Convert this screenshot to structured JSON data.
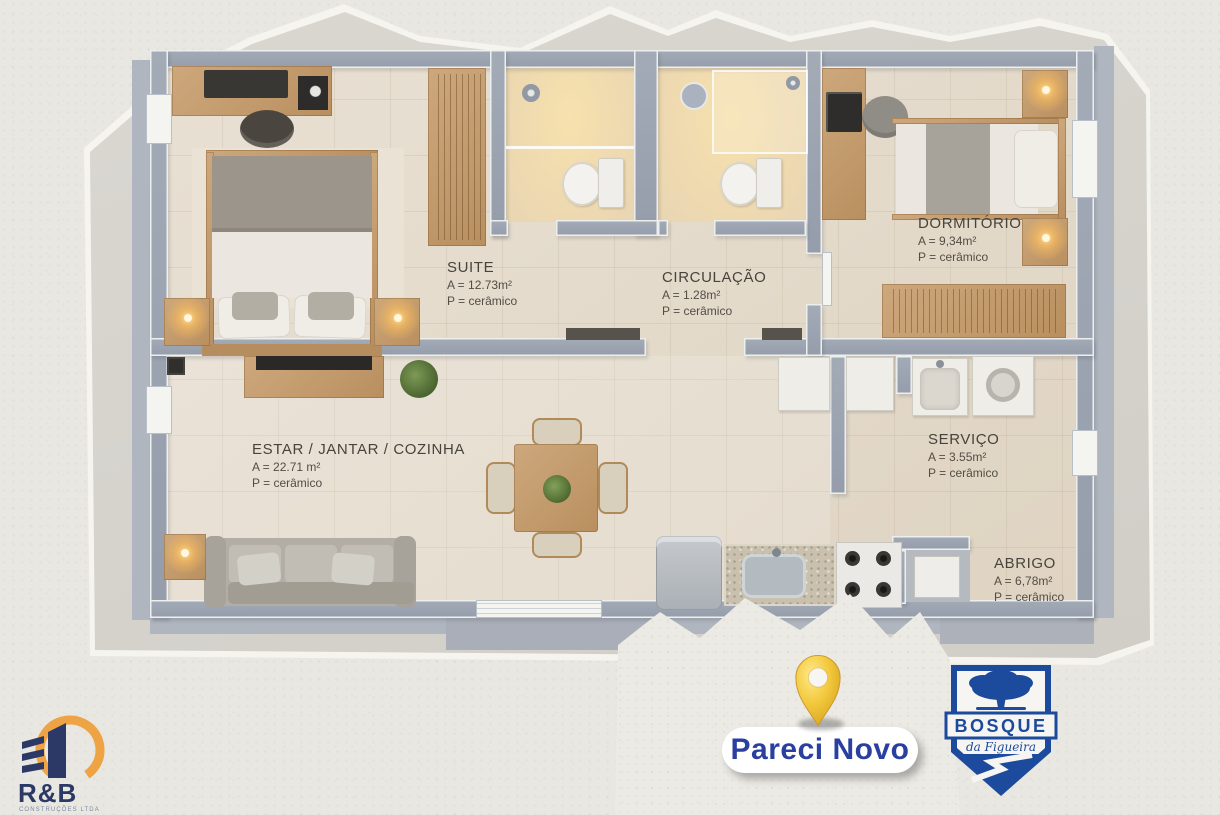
{
  "palette": {
    "page_background": "#e9e7e1",
    "paper_gray": "#d6d3cd",
    "wall_gray": "#9aa2af",
    "floor_beige": "#e5dccd",
    "bath_glow": "#f2dbae",
    "wood_tan": "#c39b6d"
  },
  "plan": {
    "rooms": [
      {
        "key": "suite",
        "name": "SUITE",
        "area": "A = 12.73m²",
        "floor": "P = cerâmico"
      },
      {
        "key": "circulacao",
        "name": "CIRCULAÇÃO",
        "area": "A = 1.28m²",
        "floor": "P = cerâmico"
      },
      {
        "key": "dormitorio",
        "name": "DORMITÓRIO",
        "area": "A = 9,34m²",
        "floor": "P = cerâmico"
      },
      {
        "key": "estar",
        "name": "ESTAR / JANTAR / COZINHA",
        "area": "A = 22.71 m²",
        "floor": "P = cerâmico"
      },
      {
        "key": "servico",
        "name": "SERVIÇO",
        "area": "A = 3.55m²",
        "floor": "P = cerâmico"
      },
      {
        "key": "abrigo",
        "name": "ABRIGO",
        "area": "A = 6,78m²",
        "floor": "P = cerâmico"
      }
    ]
  },
  "footer": {
    "location": {
      "label": "Pareci Novo",
      "pin_color": "#f1c83c",
      "text_color": "#2a3fa0"
    },
    "developer": {
      "name": "R&B",
      "subtitle": "CONSTRUÇÕES LTDA",
      "orange": "#eea344",
      "navy": "#2c3966"
    },
    "project": {
      "title": "BOSQUE",
      "subtitle": "da Figueira",
      "blue": "#1c4a9c"
    }
  }
}
